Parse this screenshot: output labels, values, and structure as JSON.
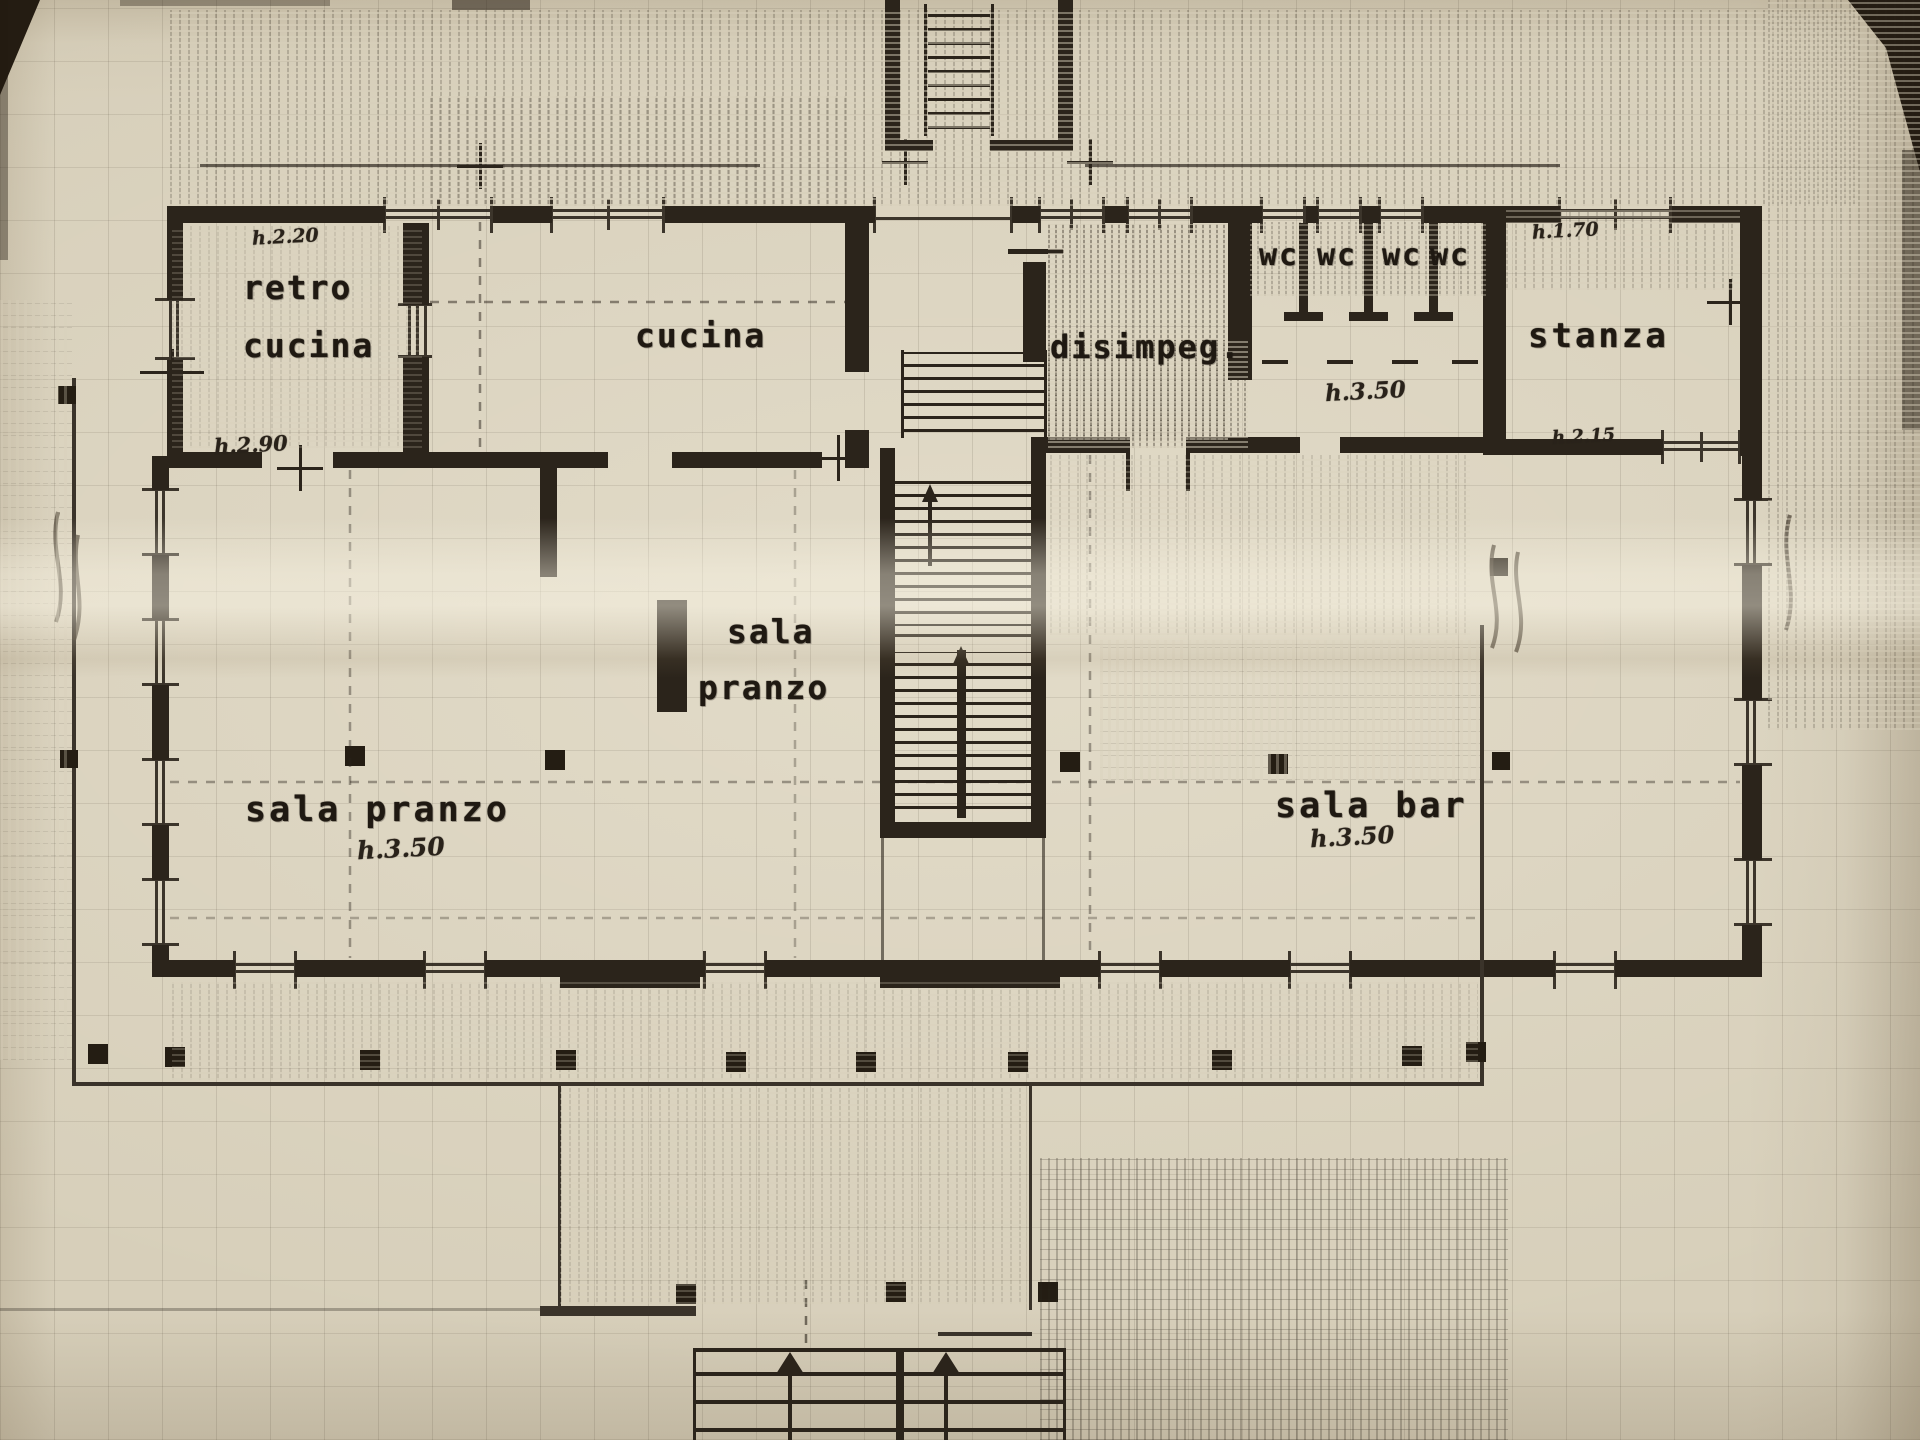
{
  "colors": {
    "paper": "#d7cfba",
    "ink": "#2b241b"
  },
  "rooms": {
    "retro_cucina": {
      "line1": "retro",
      "line2": "cucina",
      "note_top": "h.2.20",
      "note_left": "h.2.90"
    },
    "cucina": {
      "label": "cucina"
    },
    "disimpegno": {
      "label": "disimpeg."
    },
    "wc": {
      "labels": [
        "wc",
        "wc",
        "wc",
        "wc"
      ],
      "note": "h.3.50"
    },
    "stanza": {
      "label": "stanza",
      "note_top": "h.1.70",
      "note_bottom": "h.2.15"
    },
    "sala_pranzo_piccola": {
      "line1": "sala",
      "line2": "pranzo"
    },
    "sala_pranzo": {
      "label": "sala pranzo",
      "note": "h.3.50"
    },
    "sala_bar": {
      "label": "sala bar",
      "note": "h.3.50"
    }
  }
}
